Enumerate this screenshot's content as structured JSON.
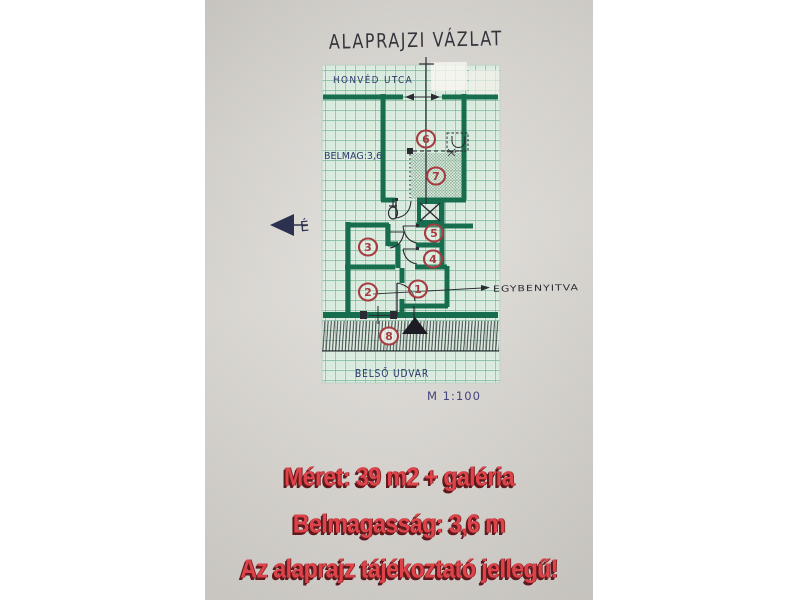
{
  "title": "ALAPRAJZI VÁZLAT",
  "plan": {
    "street": "HONVÉD UTCA",
    "ceiling_note": "BELMAG:3,6",
    "courtyard": "BELSŐ UDVAR",
    "scale": "M 1:100",
    "open_connection_note": "EGYBENYITVA",
    "north": "É",
    "rooms": [
      "1",
      "2",
      "3",
      "4",
      "5",
      "6",
      "7",
      "8"
    ]
  },
  "footer": {
    "lines": [
      "Méret: 39 m2 + galéria",
      "Belmagasság: 3,6 m",
      "Az alaprajz tájékoztató jellegű!"
    ]
  },
  "colors": {
    "wall_green": "#176e4e",
    "grid_line": "#77b796",
    "ink_black": "#2b2b33",
    "marker_red": "#a63c40",
    "footer_red": "#dd4348",
    "ink_navy": "#2d3a6b"
  }
}
